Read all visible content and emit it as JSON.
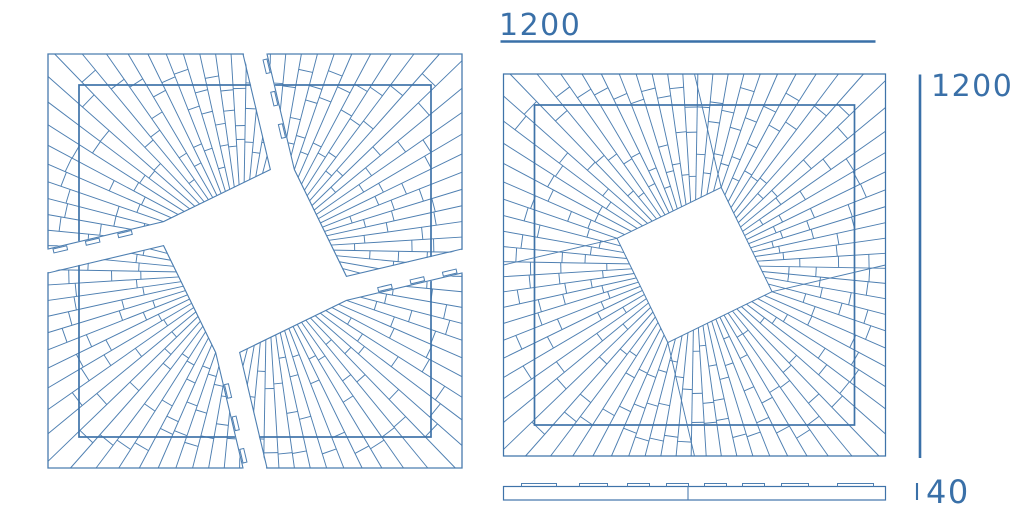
{
  "title": "Sunburst square panel technical drawing",
  "colors": {
    "line": "#4e7fb1",
    "line_strong": "#3f73a9",
    "dimension": "#3a70a8",
    "background": "#ffffff"
  },
  "dimensions": {
    "width": {
      "label": "1200"
    },
    "height": {
      "label": "1200"
    },
    "thickness": {
      "label": "40"
    }
  },
  "views": {
    "exploded": {
      "cx": 255,
      "cy": 261,
      "half": 195,
      "inset": 31,
      "diamond_radius": 84,
      "rotation_deg": -26,
      "rays": 80,
      "seed": 7,
      "gap": 12,
      "piece_names": [
        "top-left",
        "top-right",
        "bottom-right",
        "bottom-left"
      ],
      "tab_positions": [
        0.1,
        0.38,
        0.66
      ]
    },
    "assembled": {
      "cx": 694.5,
      "cy": 265,
      "half": 191,
      "inset": 31,
      "diamond_radius": 82,
      "rotation_deg": -26,
      "rays": 80,
      "seed": 13
    },
    "profile": {
      "x": 503.5,
      "y": 486.5,
      "width": 382,
      "height": 13.5,
      "seam_offset": 184.5,
      "tab_rise": 3,
      "tabs": [
        [
          18,
          53
        ],
        [
          76,
          104
        ],
        [
          124,
          146
        ],
        [
          163,
          185
        ],
        [
          201,
          223
        ],
        [
          239,
          261
        ],
        [
          278,
          305
        ],
        [
          334,
          370
        ]
      ]
    },
    "dimension_layout": {
      "width_text": [
        499,
        35
      ],
      "width_line": [
        500.5,
        41.5,
        875.5,
        41.5
      ],
      "height_line": [
        920,
        74.5,
        920,
        458
      ],
      "height_text": [
        931,
        96
      ],
      "thickness_tick": [
        917,
        483,
        917,
        500
      ],
      "thickness_text": [
        926,
        503
      ]
    }
  }
}
